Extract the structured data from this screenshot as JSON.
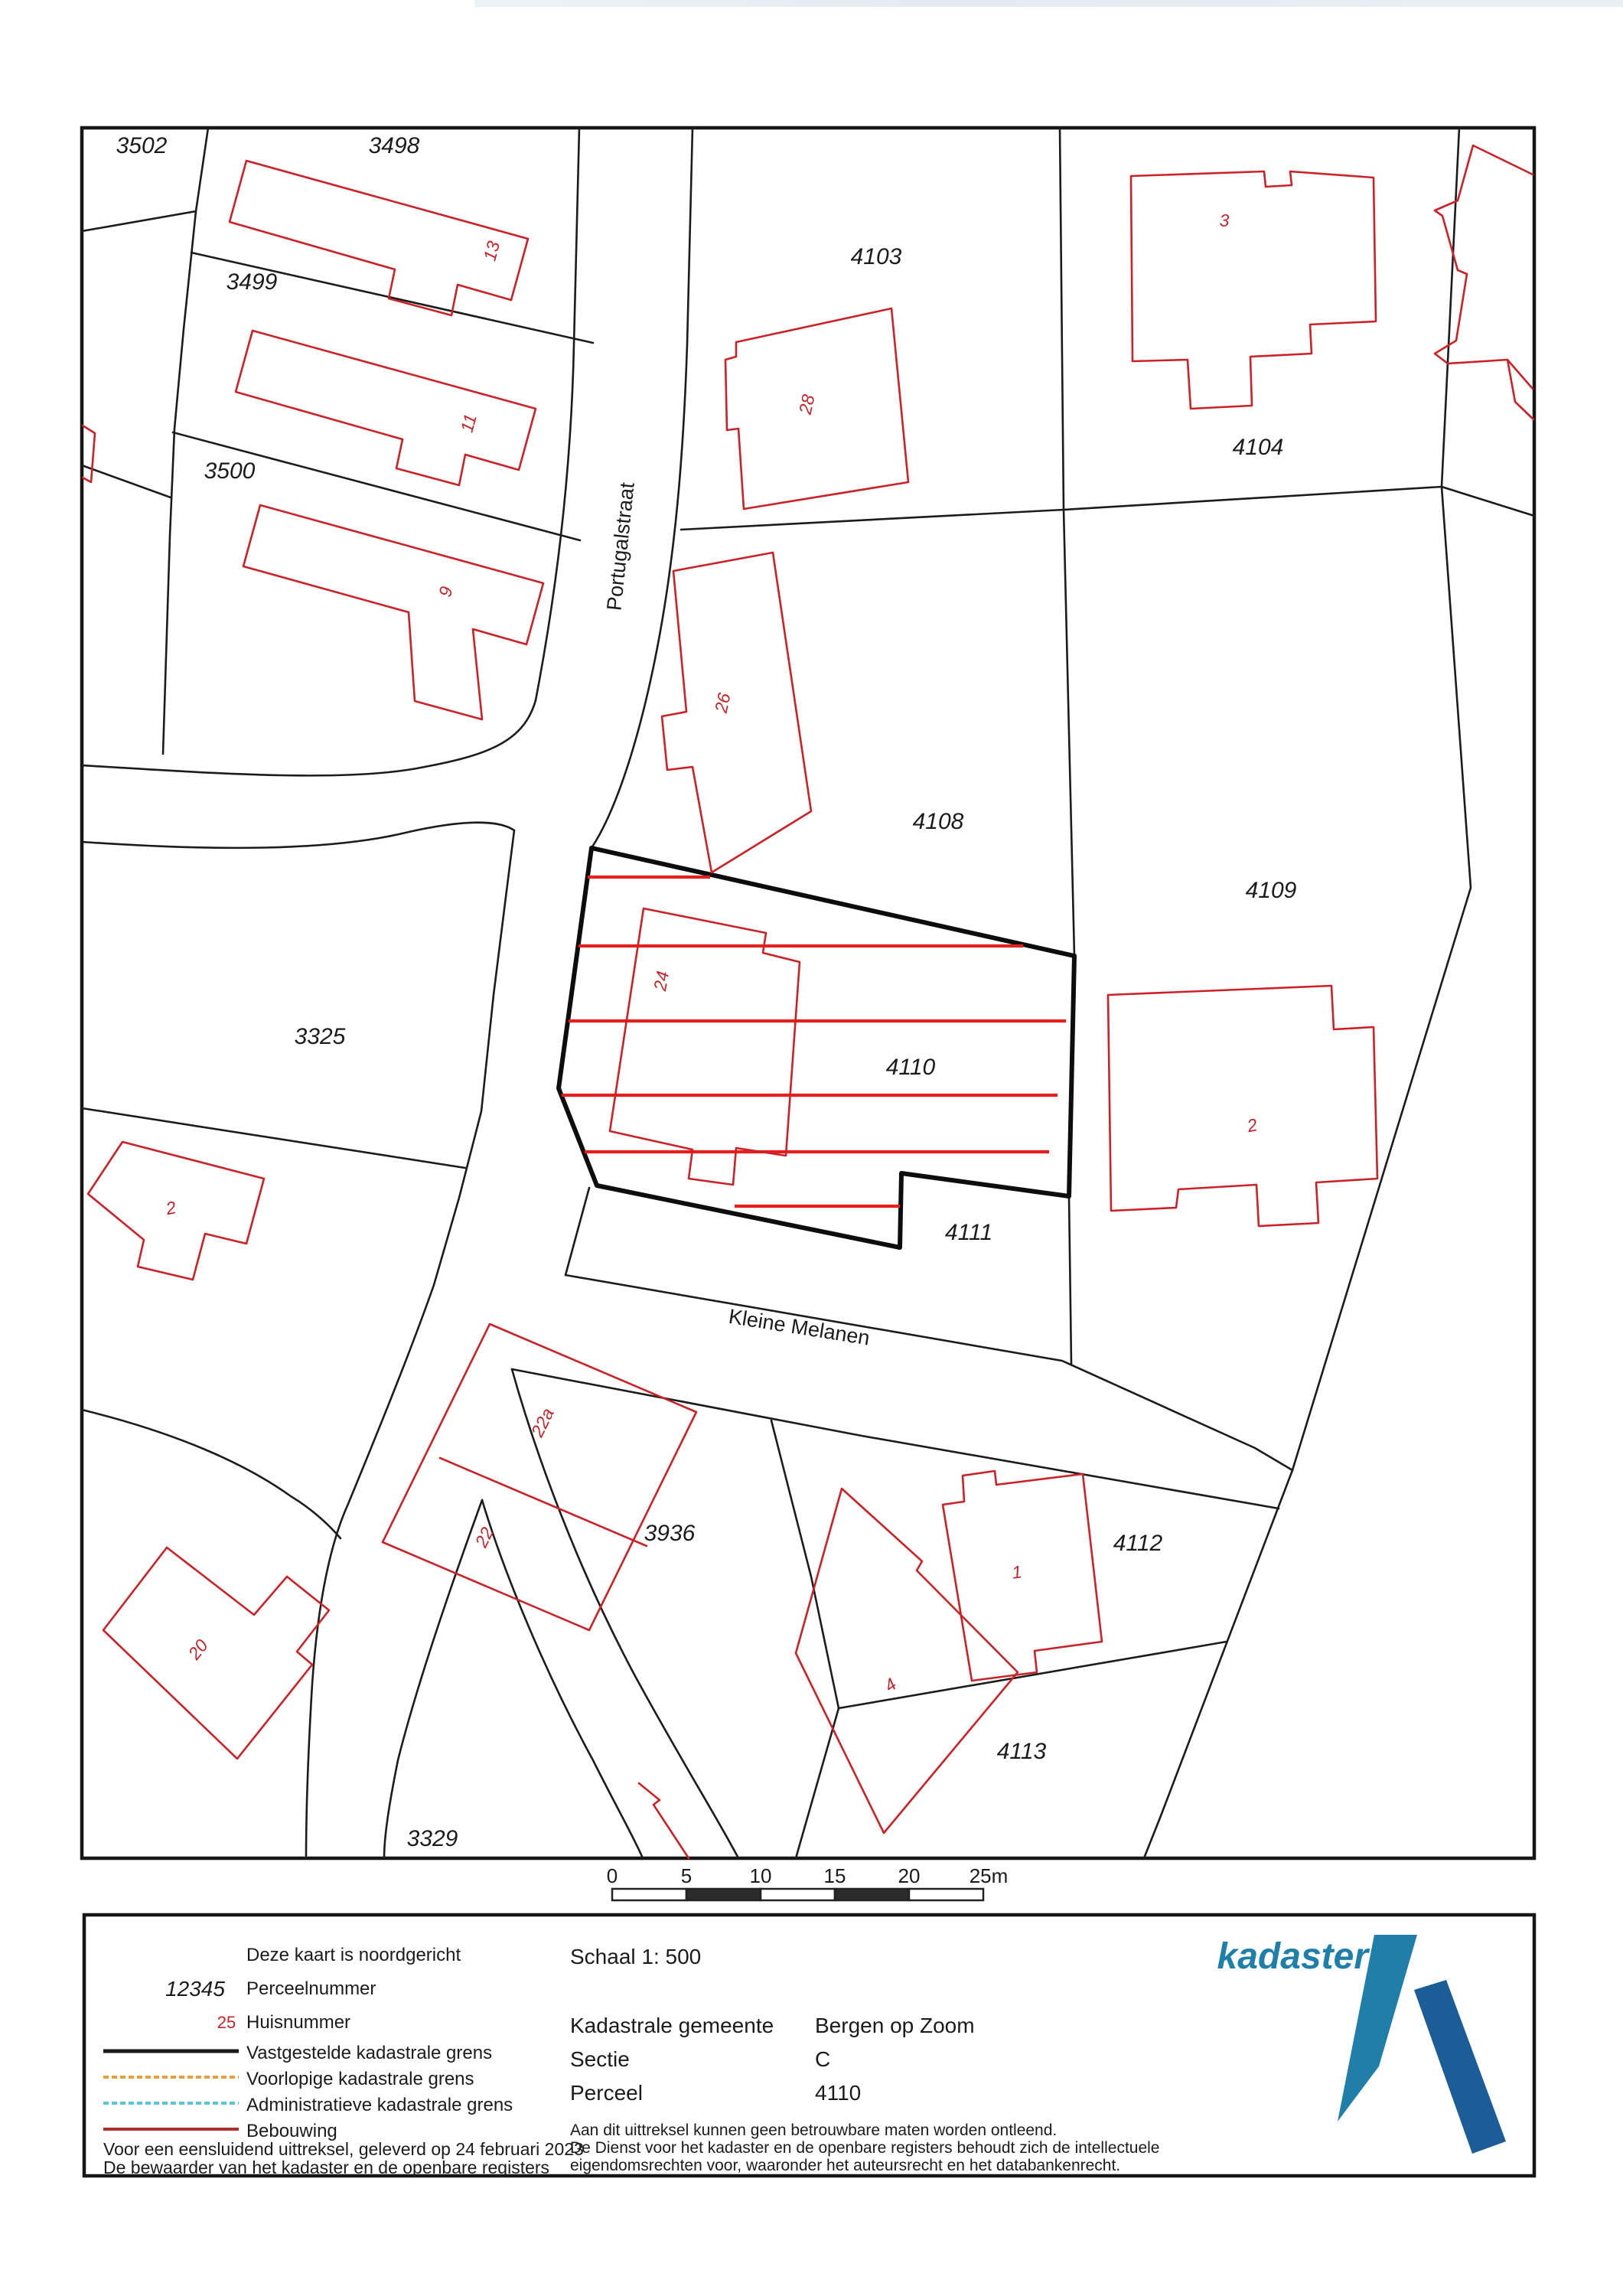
{
  "map": {
    "parcel_labels": [
      {
        "text": "3502"
      },
      {
        "text": "3498"
      },
      {
        "text": "3499"
      },
      {
        "text": "3500"
      },
      {
        "text": "4103"
      },
      {
        "text": "4104"
      },
      {
        "text": "3325"
      },
      {
        "text": "4108"
      },
      {
        "text": "4109"
      },
      {
        "text": "4110"
      },
      {
        "text": "4111"
      },
      {
        "text": "3936"
      },
      {
        "text": "4112"
      },
      {
        "text": "4113"
      },
      {
        "text": "3329"
      }
    ],
    "house_numbers": [
      {
        "text": "13"
      },
      {
        "text": "11"
      },
      {
        "text": "9"
      },
      {
        "text": "28"
      },
      {
        "text": "26"
      },
      {
        "text": "24"
      },
      {
        "text": "3"
      },
      {
        "text": "2"
      },
      {
        "text": "2"
      },
      {
        "text": "22a"
      },
      {
        "text": "22"
      },
      {
        "text": "1"
      },
      {
        "text": "20"
      },
      {
        "text": "4"
      }
    ],
    "street_labels": [
      {
        "text": "Portugalstraat"
      },
      {
        "text": "Kleine Melanen"
      }
    ],
    "scale_bar": {
      "ticks": [
        "0",
        "5",
        "10",
        "15",
        "20",
        "25m"
      ]
    }
  },
  "info": {
    "legend": {
      "north_note": "Deze kaart is noordgericht",
      "parcel_example": "12345",
      "parcel_label": "Perceelnummer",
      "house_example": "25",
      "house_label": "Huisnummer",
      "line_fixed": "Vastgestelde kadastrale grens",
      "line_preliminary": "Voorlopige kadastrale grens",
      "line_administrative": "Administratieve kadastrale grens",
      "line_building": "Bebouwing"
    },
    "schaal": "Schaal 1: 500",
    "fields": [
      {
        "label": "Kadastrale gemeente",
        "value": "Bergen op Zoom"
      },
      {
        "label": "Sectie",
        "value": "C"
      },
      {
        "label": "Perceel",
        "value": "4110"
      }
    ],
    "disclaimer": [
      "Aan dit uittreksel kunnen geen betrouwbare maten worden ontleend.",
      "De Dienst voor het kadaster en de openbare registers behoudt zich de intellectuele",
      "eigendomsrechten voor, waaronder het auteursrecht en het databankenrecht."
    ],
    "footer": [
      "Voor een eensluidend uittreksel, geleverd op 24 februari 2023",
      "De bewaarder van het kadaster en de openbare registers"
    ]
  },
  "logo": {
    "wordmark": "kadaster"
  },
  "colors": {
    "boundary_black": "#1c1c1c",
    "building_red": "#cb2227",
    "hatch_red": "#e3201e",
    "house_number_red": "#c4262b",
    "preliminary_orange": "#e79f37",
    "administrative_cyan": "#59c5d6",
    "bebouwing_dark_red": "#ad2f2a",
    "logo_teal": "#1f7fa9",
    "logo_dark_blue": "#1d5d97"
  }
}
